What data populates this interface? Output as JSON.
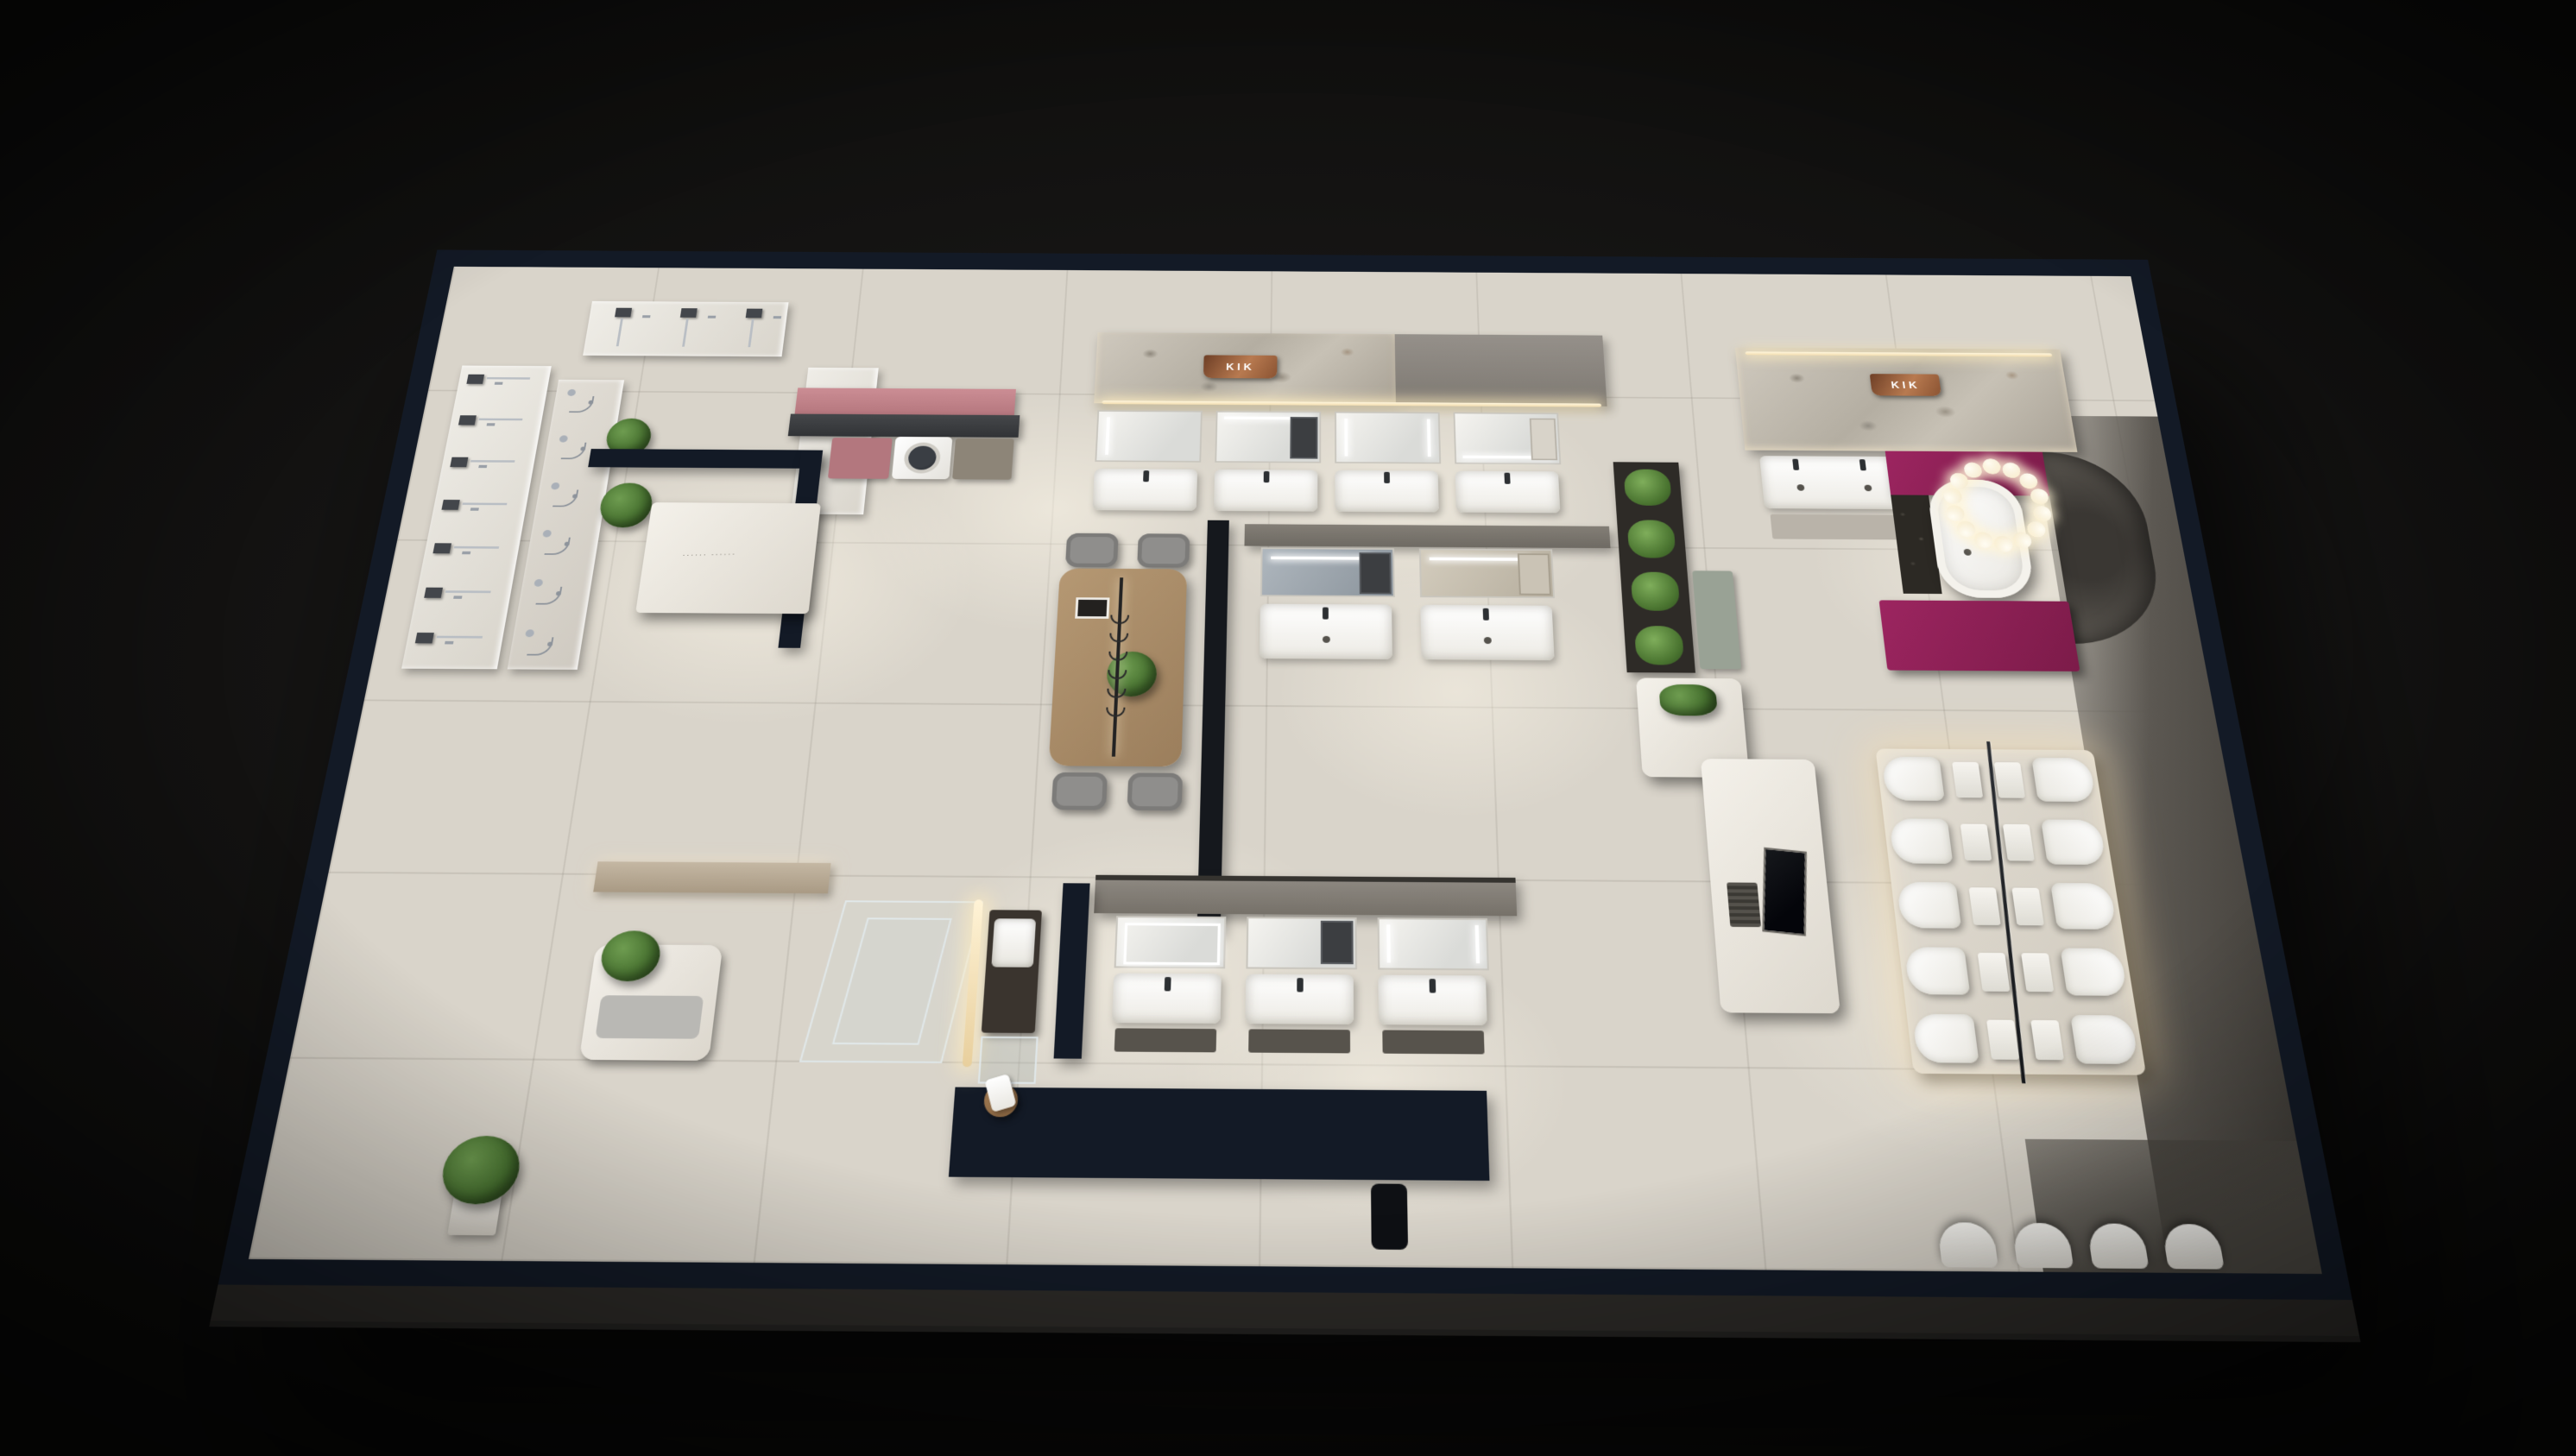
{
  "scene": {
    "type": "3d-cutaway-render-of-bathroom-fixture-showroom",
    "brand_signs": [
      {
        "text": "KIK",
        "location": "top-center stone wall",
        "plate_color": "#b87a50"
      },
      {
        "text": "KIK",
        "location": "right marble wall",
        "plate_color": "#b87a50"
      }
    ],
    "reception_desk_tagline": "······  ······",
    "colors": {
      "background": "#0a0a09",
      "wall_cut_top": "#131a26",
      "floor_tile": "#d9d4ca",
      "stone_wall": "#b4aea2",
      "accent_magenta": "#8e2054",
      "accent_pink_wall": "#c5868d",
      "plant_green": "#4a7430",
      "wood": "#a98d6f",
      "led_warm": "#f6e7c3",
      "copper_sign": "#b87a50",
      "concrete_dark": "#5c5852"
    },
    "fixtures": {
      "shower_wall_stations": 7,
      "hand_shower_sets": 6,
      "corner_shower_stations": 3,
      "top_vanity_units": 4,
      "island_vanity_units": 2,
      "lower_vanity_units": 3,
      "double_basin_vanities": 1,
      "toilet_sides": 2,
      "toilet_rows_per_side": 5,
      "rear_wall_toilets": 4,
      "dining_chairs": 4,
      "pendant_hooks": 6,
      "ring_chandelier_bulbs": 14,
      "washing_machines": 1,
      "bathtubs": 1
    },
    "areas": [
      "shower-hardware-display-wall",
      "reception",
      "laundry-nook",
      "top-vanity-gallery",
      "consultation-table",
      "island-vanity-displays",
      "vertical-plant-wall",
      "bathtub-vignette",
      "toilet-display-platform",
      "media-island",
      "lower-vanity-gallery",
      "shower-glass-vignette",
      "entry-corridor"
    ]
  }
}
